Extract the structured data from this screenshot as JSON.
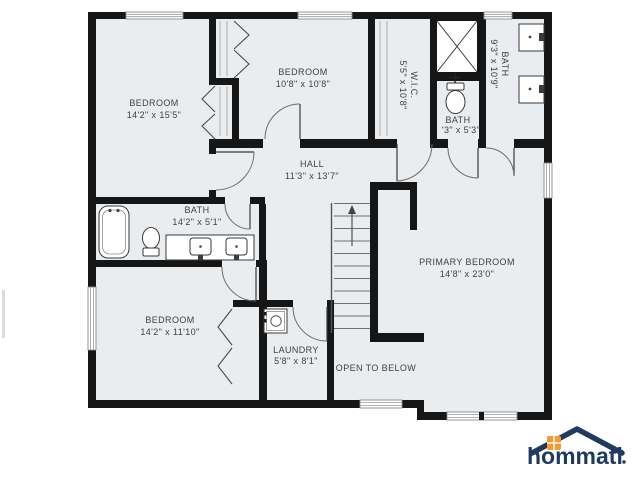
{
  "floor_plan": {
    "rooms": {
      "bedroom_top_left": {
        "name": "BEDROOM",
        "dims": "14'2\" x 15'5\""
      },
      "bedroom_top_middle": {
        "name": "BEDROOM",
        "dims": "10'8\" x 10'8\""
      },
      "wic": {
        "name": "W.I.C.",
        "dims": "5'5\" x 10'8\""
      },
      "bath_top_right": {
        "name": "BATH",
        "dims": "9'3\" x 10'9\""
      },
      "bath_small": {
        "name": "BATH",
        "dims": "'3\" x 5'3\""
      },
      "hall": {
        "name": "HALL",
        "dims": "11'3\" x 13'7\""
      },
      "bath_left": {
        "name": "BATH",
        "dims": "14'2\" x 5'1\""
      },
      "primary_bedroom": {
        "name": "PRIMARY BEDROOM",
        "dims": "14'8\" x 23'0\""
      },
      "bedroom_bottom_left": {
        "name": "BEDROOM",
        "dims": "14'2\" x 11'10\""
      },
      "laundry": {
        "name": "LAUNDRY",
        "dims": "5'8\" x 8'1\""
      },
      "open_to_below": {
        "name": "OPEN TO BELOW"
      }
    },
    "logo": {
      "text": "hommati"
    },
    "colors": {
      "wall": "#161616",
      "room_fill": "#e9edf0",
      "logo_navy": "#1e3a5f",
      "logo_orange": "#f49b33"
    }
  }
}
